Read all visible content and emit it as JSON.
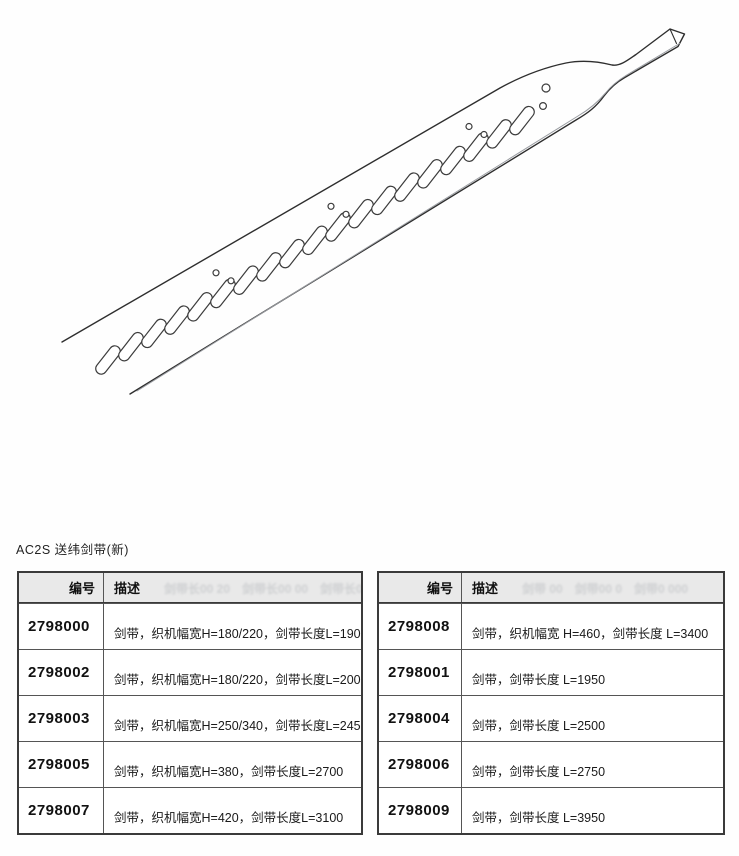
{
  "page": {
    "title": "AC2S 送纬剑带(新)"
  },
  "diagram": {
    "label": "rapier-tape-technical-drawing",
    "slot_count": 19,
    "hole_group_anchor_slots": [
      4,
      9,
      15
    ],
    "tip_holes": [
      [
        546,
        88,
        4
      ],
      [
        543,
        106,
        3.4
      ]
    ],
    "stroke_color": "#2e2e2e",
    "thickness_line_color": "#9a9da2"
  },
  "tables": [
    {
      "headers": {
        "id": "编号",
        "desc": "描述"
      },
      "ghost": "剑带长00 20　剑带长00 00　剑带长000",
      "rows": [
        {
          "id": "2798000",
          "desc": "剑带，织机幅宽H=180/220，剑带长度L=1900"
        },
        {
          "id": "2798002",
          "desc": "剑带，织机幅宽H=180/220，剑带长度L=2000"
        },
        {
          "id": "2798003",
          "desc": "剑带，织机幅宽H=250/340，剑带长度L=2450"
        },
        {
          "id": "2798005",
          "desc": "剑带，织机幅宽H=380，剑带长度L=2700"
        },
        {
          "id": "2798007",
          "desc": "剑带，织机幅宽H=420，剑带长度L=3100"
        }
      ]
    },
    {
      "headers": {
        "id": "编号",
        "desc": "描述"
      },
      "ghost": "剑带 00　剑带00 0　剑带0 000",
      "rows": [
        {
          "id": "2798008",
          "desc": "剑带，织机幅宽 H=460，剑带长度 L=3400"
        },
        {
          "id": "2798001",
          "desc": "剑带，剑带长度 L=1950"
        },
        {
          "id": "2798004",
          "desc": "剑带，剑带长度 L=2500"
        },
        {
          "id": "2798006",
          "desc": "剑带，剑带长度 L=2750"
        },
        {
          "id": "2798009",
          "desc": "剑带，剑带长度 L=3950"
        }
      ]
    }
  ],
  "colors": {
    "table_border": "#3a3a3a",
    "header_bg": "#e9e9e9",
    "text": "#1a1a1a"
  }
}
